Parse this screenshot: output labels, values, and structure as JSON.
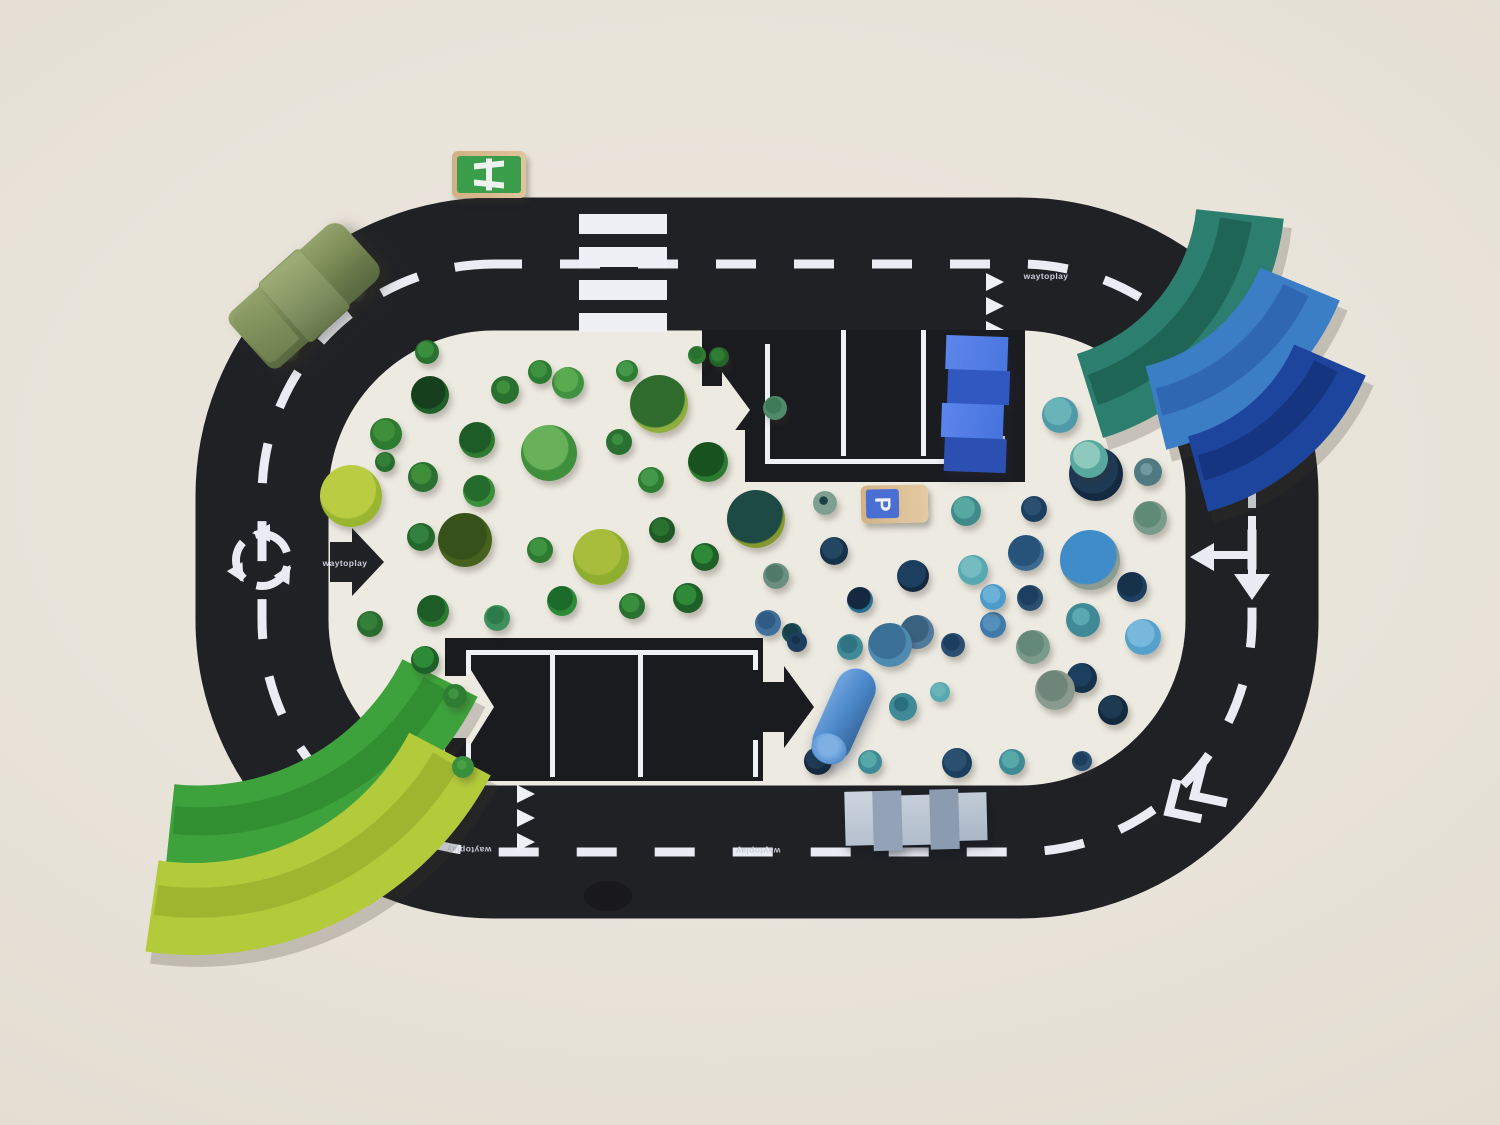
{
  "scene": {
    "background": "#e8e3d9",
    "infield": "#edeae1",
    "road_color": "#1f2125",
    "lot_color": "#1a1b1f",
    "marking_color": "#e9ecf2"
  },
  "brand": {
    "label": "waytoplay"
  },
  "signs": {
    "parking_label": "P",
    "parking_colors": {
      "wood": "#d3b286",
      "panel": "#4a6fd2"
    },
    "motorway_colors": {
      "wood": "#d2b083",
      "panel": "#3a9e4a"
    }
  },
  "vehicles": {
    "car_color": "#7d8d58",
    "wheel_color": "#26271f"
  },
  "arches": {
    "teal": "#2c7e6e",
    "blue": "#3c7ec6",
    "navy": "#1e459e",
    "green": "#3da23c",
    "lime": "#b3ca3b"
  },
  "pieces": {
    "bridge_blue": [
      "#4a76e0",
      "#3058c0"
    ],
    "bridge_gray": [
      "#c8d1dc",
      "#96a5b8"
    ],
    "cylinder_blue": "#4a86c8"
  },
  "trees": {
    "green": [
      [
        430,
        395,
        19,
        "#1f5f28",
        "#153f1d",
        55
      ],
      [
        505,
        390,
        14,
        "#2a7030",
        "#3f8f3a",
        28
      ],
      [
        568,
        383,
        16,
        "#3f9340",
        "#5aab50",
        45
      ],
      [
        627,
        371,
        11,
        "#2f7d33",
        "#43984a",
        40
      ],
      [
        659,
        404,
        29,
        "#8fae3f",
        "#2f6b2d",
        60
      ],
      [
        697,
        355,
        9,
        "#2f7d33",
        "#2a7030",
        40
      ],
      [
        719,
        357,
        10,
        "#25632a",
        "#2f7d33",
        40
      ],
      [
        477,
        440,
        18,
        "#2d7a31",
        "#1d5c26",
        55
      ],
      [
        423,
        477,
        15,
        "#2a7030",
        "#3f8f3a",
        40
      ],
      [
        386,
        434,
        16,
        "#2d7a31",
        "#3f8f3a",
        40
      ],
      [
        385,
        462,
        10,
        "#2a6b2f",
        "#34803a",
        40
      ],
      [
        549,
        453,
        28,
        "#3f8f3c",
        "#68b05a",
        48
      ],
      [
        619,
        442,
        13,
        "#2a7030",
        "#3a8f3f",
        25
      ],
      [
        708,
        462,
        20,
        "#2a7a2f",
        "#17521f",
        55
      ],
      [
        651,
        480,
        13,
        "#2f7d33",
        "#43984a",
        40
      ],
      [
        479,
        491,
        16,
        "#3a8f3c",
        "#256b2b",
        50
      ],
      [
        421,
        537,
        14,
        "#24692c",
        "#338040",
        40
      ],
      [
        351,
        496,
        31,
        "#9ab530",
        "#b9cc42",
        55
      ],
      [
        465,
        540,
        27,
        "#47621f",
        "#37511a",
        55
      ],
      [
        540,
        550,
        13,
        "#2d7a31",
        "#3f9340",
        40
      ],
      [
        601,
        557,
        28,
        "#8fae2f",
        "#a9bd3c",
        50
      ],
      [
        662,
        530,
        13,
        "#1d5a26",
        "#2a7030",
        40
      ],
      [
        705,
        557,
        14,
        "#1f6029",
        "#2d8a36",
        40
      ],
      [
        756,
        519,
        29,
        "#85992e",
        "#1d4a44",
        62
      ],
      [
        562,
        601,
        15,
        "#2d8a36",
        "#1d6b2a",
        50
      ],
      [
        632,
        606,
        13,
        "#2a7030",
        "#3a8f3f",
        40
      ],
      [
        688,
        598,
        15,
        "#1f6029",
        "#2f8a38",
        40
      ],
      [
        433,
        611,
        16,
        "#2d7a31",
        "#1d5c26",
        52
      ],
      [
        497,
        618,
        13,
        "#3f8f5c",
        "#2d7a4a",
        40
      ],
      [
        776,
        576,
        13,
        "#6a8f80",
        "#527a6a",
        40
      ],
      [
        425,
        660,
        14,
        "#1f6029",
        "#2d8a36",
        45
      ],
      [
        370,
        624,
        13,
        "#2a6b2f",
        "#34803a",
        40
      ],
      [
        455,
        696,
        12,
        "#2f7d33",
        "#3f9340",
        25
      ],
      [
        463,
        767,
        11,
        "#3a8f3c",
        "#4aa045",
        25
      ],
      [
        427,
        352,
        12,
        "#2a7030",
        "#3a8f3f",
        40
      ],
      [
        540,
        372,
        12,
        "#2d7a31",
        "#3f9340",
        40
      ],
      [
        775,
        408,
        12,
        "#4f8a6a",
        "#3f7a58",
        40
      ],
      [
        792,
        633,
        10,
        "#1d4c56",
        "#16404a",
        40
      ]
    ],
    "blue": [
      [
        1060,
        415,
        18,
        "#4f9aa8",
        "#68b4b8",
        45
      ],
      [
        1096,
        474,
        27,
        "#142a40",
        "#1e3a55",
        55
      ],
      [
        1089,
        459,
        19,
        "#57a89e",
        "#8fc8bc",
        42
      ],
      [
        1148,
        472,
        14,
        "#4f7a82",
        "#6f9aa0",
        25
      ],
      [
        1150,
        518,
        17,
        "#7a9a8a",
        "#5f8a76",
        45
      ],
      [
        1026,
        553,
        18,
        "#3a6a92",
        "#27527a",
        55
      ],
      [
        1090,
        560,
        30,
        "#8c9c90",
        "#3f8cc8",
        60
      ],
      [
        1132,
        587,
        15,
        "#1d3f5f",
        "#16324a",
        50
      ],
      [
        1030,
        598,
        13,
        "#2a4f6f",
        "#1d3f5f",
        45
      ],
      [
        1083,
        620,
        17,
        "#3f8a96",
        "#5aa8b0",
        30
      ],
      [
        993,
        625,
        13,
        "#3f7aa8",
        "#5590bc",
        40
      ],
      [
        1143,
        637,
        18,
        "#55a0cc",
        "#78b8dc",
        45
      ],
      [
        1033,
        647,
        17,
        "#7a9a8a",
        "#62897a",
        45
      ],
      [
        1082,
        678,
        15,
        "#16324a",
        "#1d3f5f",
        45
      ],
      [
        1055,
        690,
        20,
        "#8a9a8f",
        "#70857a",
        45
      ],
      [
        966,
        511,
        15,
        "#3f8a8a",
        "#57a8a0",
        42
      ],
      [
        1034,
        509,
        13,
        "#1d3f5f",
        "#2a4f6f",
        40
      ],
      [
        834,
        551,
        14,
        "#16324a",
        "#234663",
        45
      ],
      [
        913,
        576,
        16,
        "#14293f",
        "#1d3f5f",
        55
      ],
      [
        973,
        570,
        15,
        "#57a8b0",
        "#74bcc0",
        42
      ],
      [
        825,
        503,
        12,
        "#7fa091",
        "#1d3f4a",
        20
      ],
      [
        860,
        600,
        13,
        "#2a6f8f",
        "#14293f",
        55
      ],
      [
        993,
        597,
        13,
        "#4f9ac8",
        "#6ab0d8",
        40
      ],
      [
        917,
        632,
        17,
        "#4f7a9a",
        "#3a627f",
        48
      ],
      [
        890,
        645,
        22,
        "#4f8ab0",
        "#3a6f96",
        50
      ],
      [
        768,
        623,
        13,
        "#3f6f9a",
        "#2e5a84",
        40
      ],
      [
        850,
        647,
        13,
        "#3f8a96",
        "#2f7482",
        40
      ],
      [
        953,
        645,
        12,
        "#2a4f6f",
        "#1d3f5f",
        40
      ],
      [
        797,
        642,
        10,
        "#1d3f5f",
        "#16324a",
        25
      ],
      [
        818,
        761,
        14,
        "#14293f",
        "#1f3c58",
        45
      ],
      [
        870,
        762,
        12,
        "#3f8a96",
        "#57a8a8",
        40
      ],
      [
        957,
        763,
        15,
        "#1d3f5f",
        "#2a4f6f",
        45
      ],
      [
        1012,
        762,
        13,
        "#3f8a96",
        "#57a8a8",
        40
      ],
      [
        1082,
        761,
        10,
        "#2a4f6f",
        "#1d3f5f",
        40
      ],
      [
        1113,
        710,
        15,
        "#14293f",
        "#1d3a52",
        45
      ],
      [
        903,
        707,
        14,
        "#3f8a96",
        "#2a6f7f",
        30
      ],
      [
        940,
        692,
        10,
        "#57a8b0",
        "#6ab4b8",
        40
      ]
    ]
  }
}
